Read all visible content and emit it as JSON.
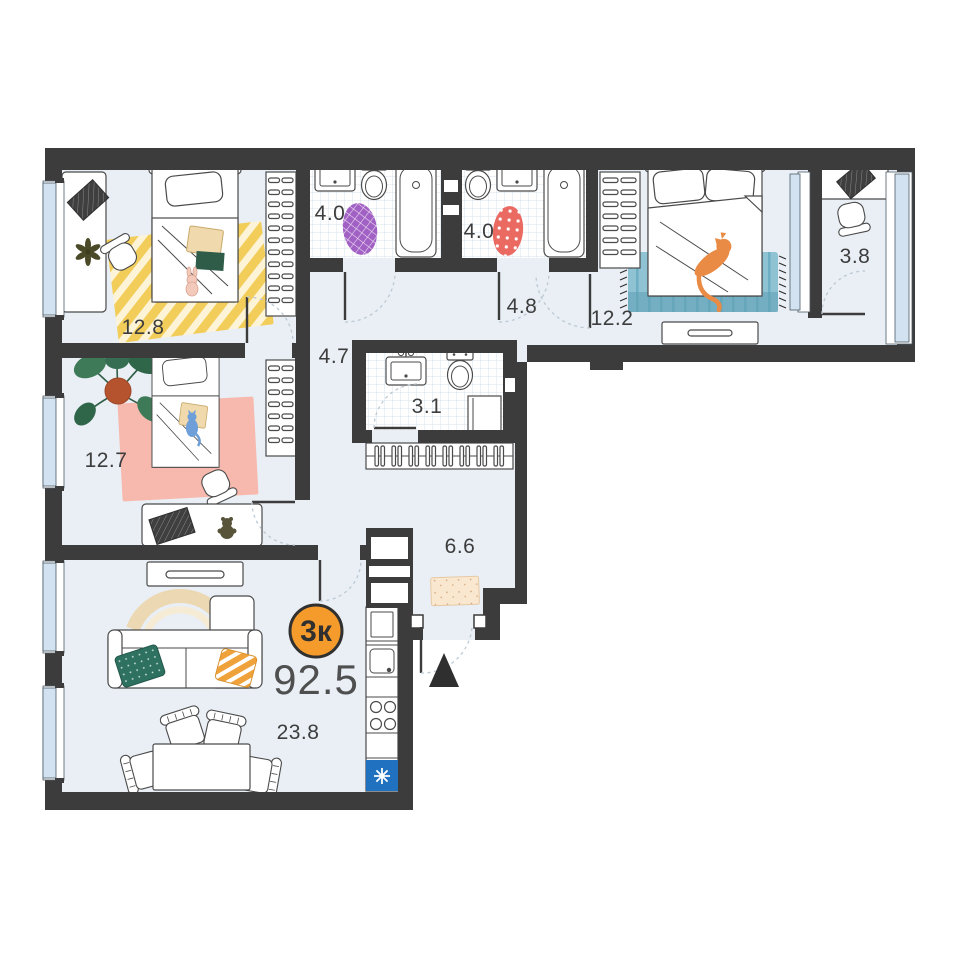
{
  "plan": {
    "type_badge": "3к",
    "total_area": "92.5",
    "rooms": [
      {
        "name": "bedroom-top",
        "area": "12.8"
      },
      {
        "name": "bathroom-left",
        "area": "4.0"
      },
      {
        "name": "bathroom-right",
        "area": "4.0"
      },
      {
        "name": "hallway-top",
        "area": "4.8"
      },
      {
        "name": "bedroom-right",
        "area": "12.2"
      },
      {
        "name": "balcony",
        "area": "3.8"
      },
      {
        "name": "corridor",
        "area": "4.7"
      },
      {
        "name": "bathroom-small",
        "area": "3.1"
      },
      {
        "name": "bedroom-left",
        "area": "12.7"
      },
      {
        "name": "hallway-entrance",
        "area": "6.6"
      },
      {
        "name": "living-kitchen",
        "area": "23.8"
      }
    ],
    "colors": {
      "badge_bg": "#f59b2c",
      "badge_border": "#303030",
      "wall": "#3c3c3c",
      "floor": "#e9eff5",
      "window_glass": "#d3e2f1",
      "area_text": "#3d3d3d",
      "total_text": "#4f4f4f",
      "entrance_marker": "#2f2f2f",
      "appliance_blue": "#2071bf"
    }
  }
}
